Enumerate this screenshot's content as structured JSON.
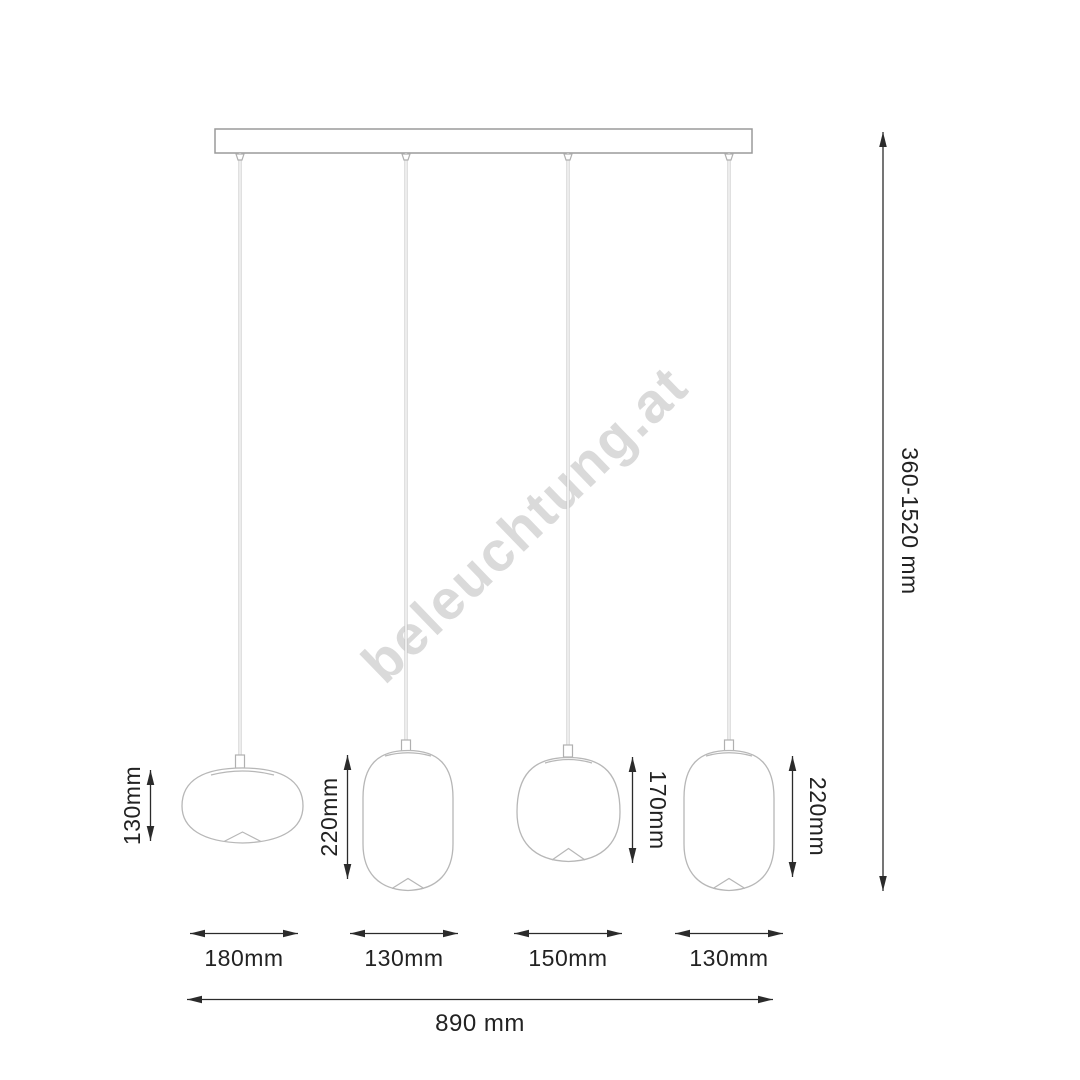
{
  "watermark": {
    "text": "beleuchtung.at",
    "color": "#dadada"
  },
  "colors": {
    "background": "#ffffff",
    "fixture_outline": "#b7b7b7",
    "bar_outline": "#9a9a9a",
    "dimension_ink": "#222222"
  },
  "dimensions": {
    "total_width": "890 mm",
    "suspension_height": "360-1520 mm",
    "pendant_heights": [
      "130mm",
      "220mm",
      "170mm",
      "220mm"
    ],
    "pendant_widths": [
      "180mm",
      "130mm",
      "150mm",
      "130mm"
    ]
  }
}
